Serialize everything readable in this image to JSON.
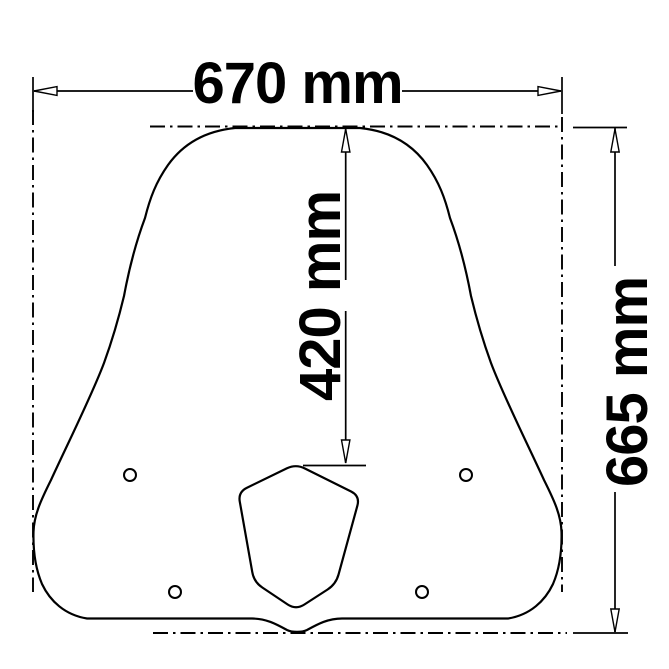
{
  "canvas": {
    "background": "#ffffff",
    "line_color": "#000000"
  },
  "drawing": {
    "type": "technical dimension drawing",
    "subject": "windscreen front-view outline with headlight cutout and mounting holes",
    "dimensions": [
      {
        "id": "overall-width",
        "label": "670 mm",
        "orientation": "horizontal",
        "position": "top"
      },
      {
        "id": "top-to-cutout-height",
        "label": "420 mm",
        "orientation": "vertical",
        "position": "center"
      },
      {
        "id": "overall-height",
        "label": "665 mm",
        "orientation": "vertical",
        "position": "right"
      }
    ],
    "mounting_hole_count": 4
  }
}
